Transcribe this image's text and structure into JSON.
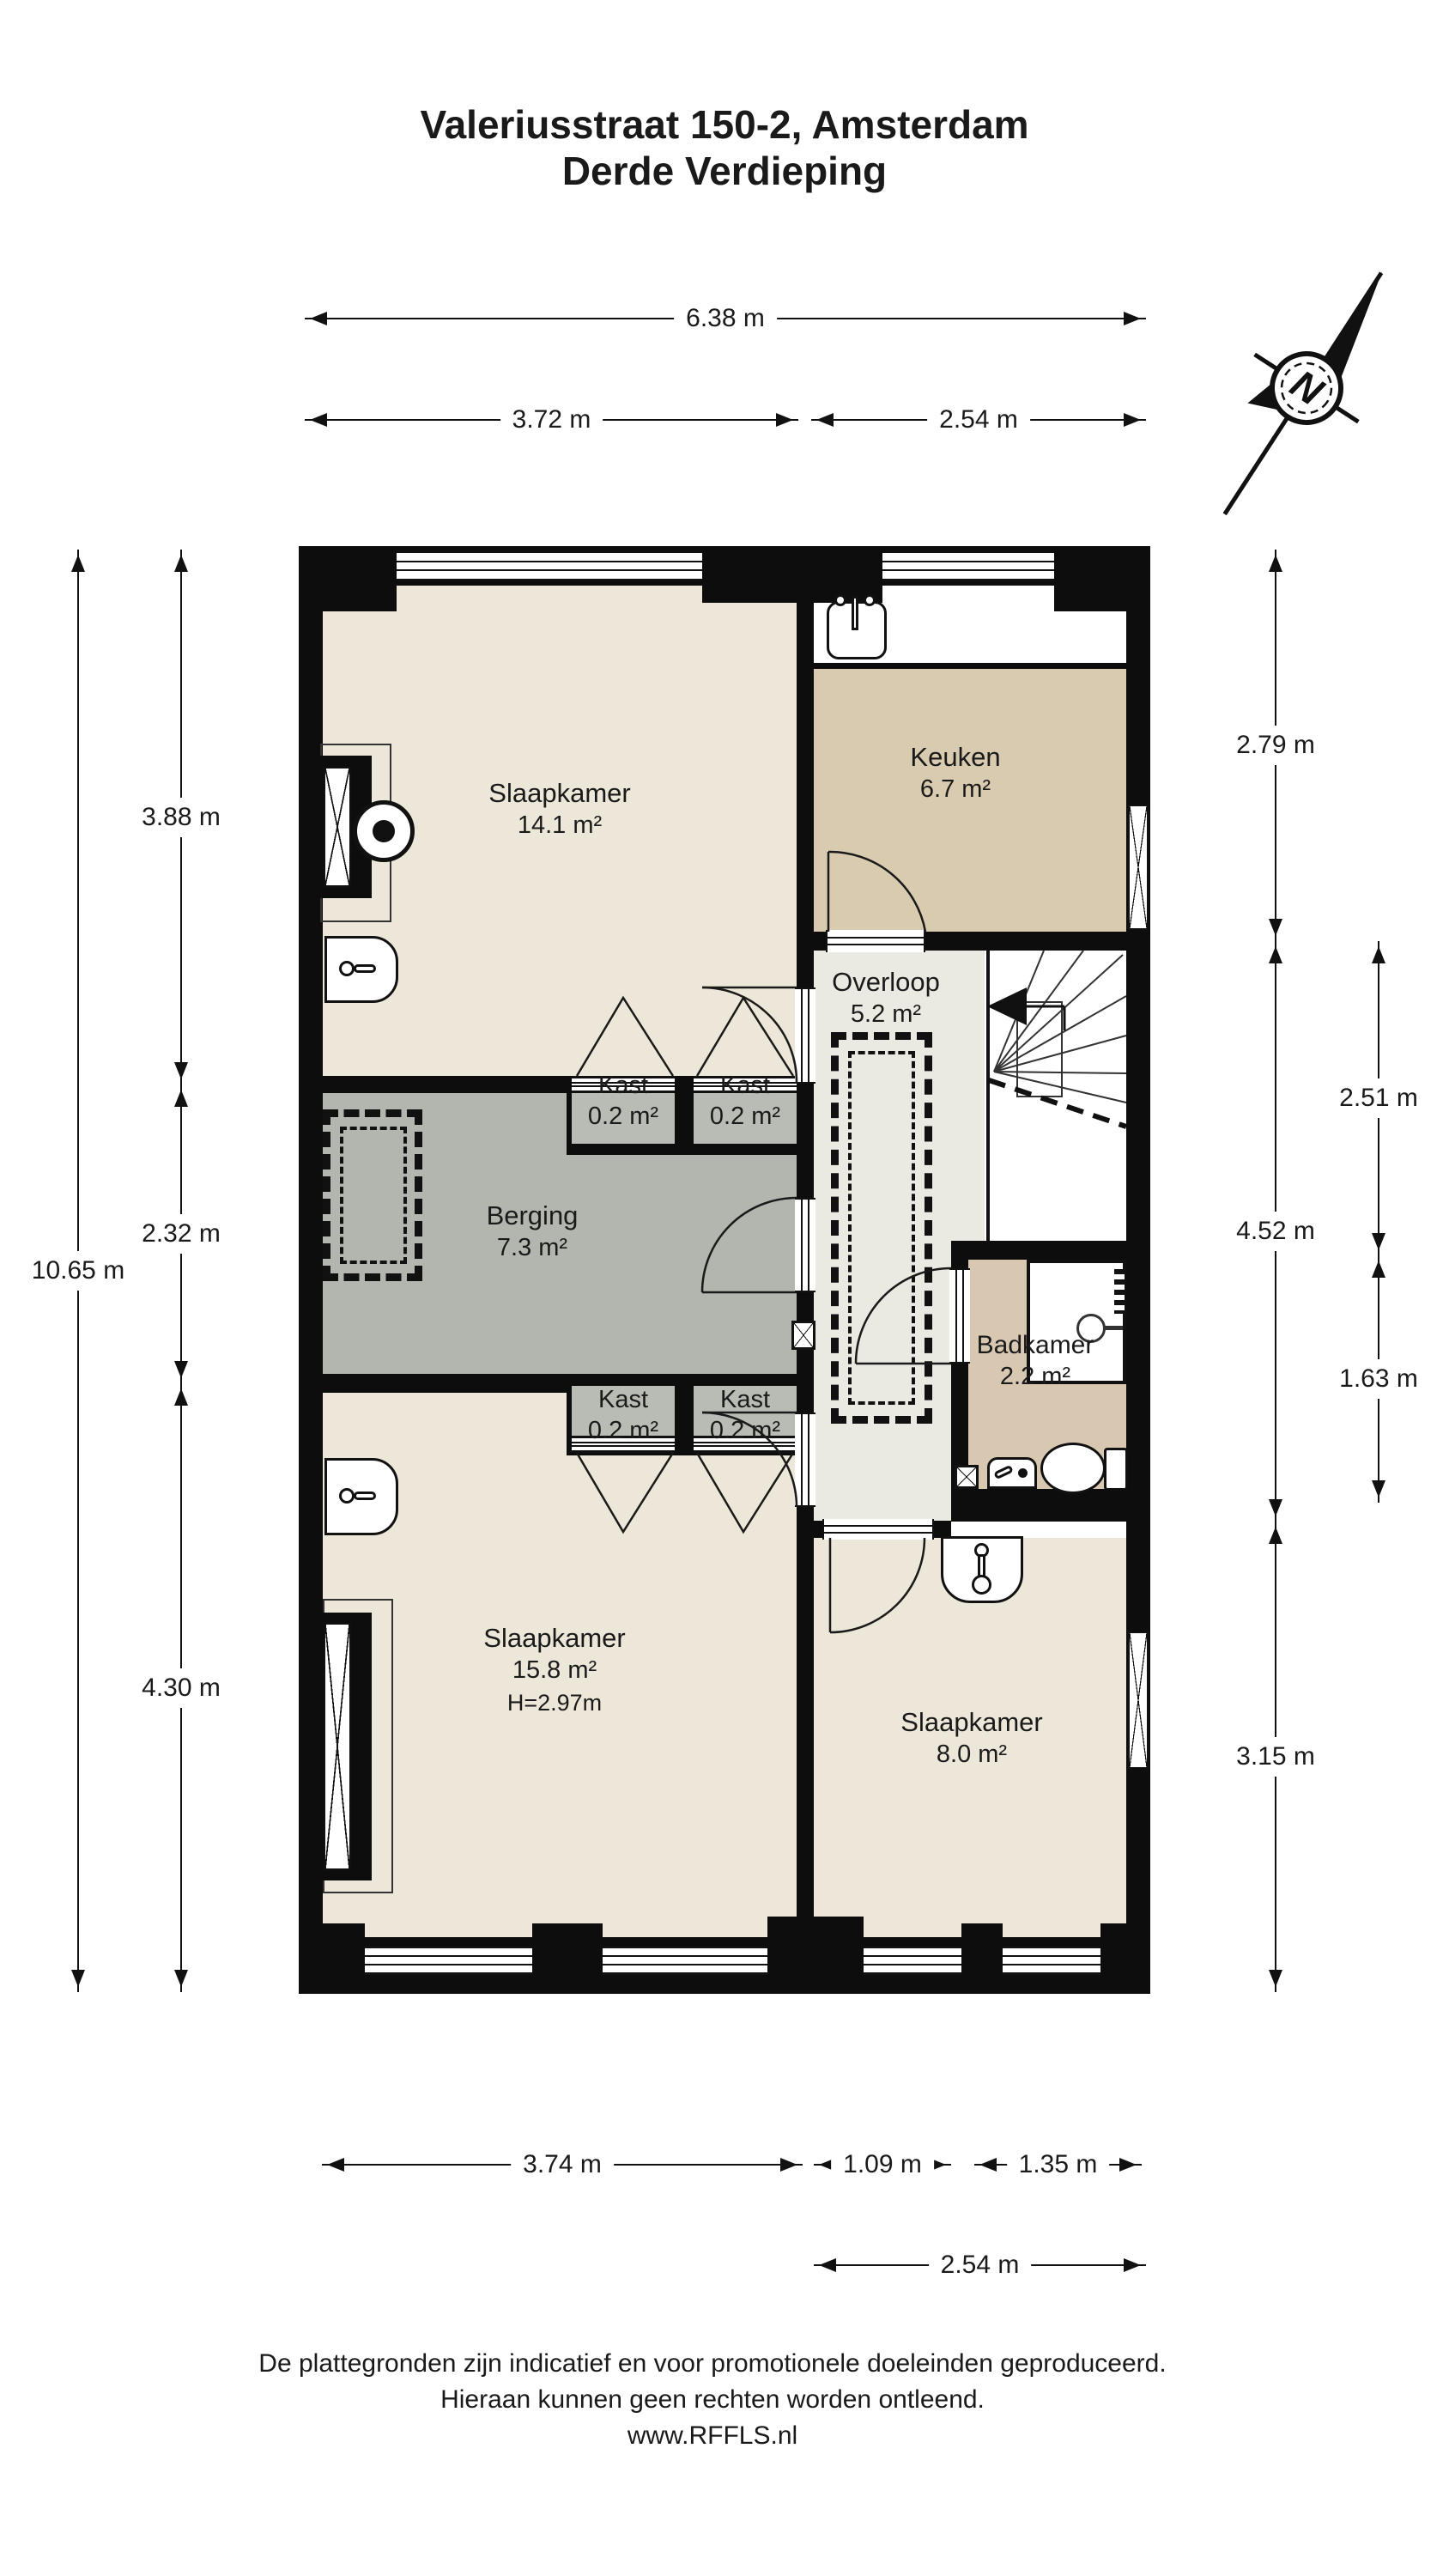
{
  "title": {
    "line1": "Valeriusstraat 150-2, Amsterdam",
    "line2": "Derde Verdieping"
  },
  "rooms": {
    "slaapkamer1": {
      "name": "Slaapkamer",
      "area": "14.1 m²"
    },
    "keuken": {
      "name": "Keuken",
      "area": "6.7 m²"
    },
    "overloop": {
      "name": "Overloop",
      "area": "5.2 m²"
    },
    "berging": {
      "name": "Berging",
      "area": "7.3 m²"
    },
    "badkamer": {
      "name": "Badkamer",
      "area": "2.2 m²"
    },
    "slaapkamer2": {
      "name": "Slaapkamer",
      "area": "15.8 m²",
      "height": "H=2.97m"
    },
    "slaapkamer3": {
      "name": "Slaapkamer",
      "area": "8.0 m²"
    },
    "kast1": {
      "name": "Kast",
      "area": "0.2 m²"
    },
    "kast2": {
      "name": "Kast",
      "area": "0.2 m²"
    },
    "kast3": {
      "name": "Kast",
      "area": "0.2 m²"
    },
    "kast4": {
      "name": "Kast",
      "area": "0.2 m²"
    }
  },
  "dimensions": {
    "top_total": "6.38 m",
    "top_left": "3.72 m",
    "top_right": "2.54 m",
    "left_total": "10.65 m",
    "left_1": "3.88 m",
    "left_2": "2.32 m",
    "left_3": "4.30 m",
    "right_1": "2.79 m",
    "right_2": "4.52 m",
    "right_3": "3.15 m",
    "right_outer_1": "2.51 m",
    "right_outer_2": "1.63 m",
    "bottom_1": "3.74 m",
    "bottom_2": "1.09 m",
    "bottom_3": "1.35 m",
    "bottom_total": "2.54 m"
  },
  "compass": {
    "north_label": "N"
  },
  "footer": {
    "line1": "De plattegronden zijn indicatief en voor promotionele doeleinden geproduceerd.",
    "line2": "Hieraan kunnen geen rechten worden ontleend.",
    "line3": "www.RFFLS.nl"
  },
  "colors": {
    "wall": "#0d0d0d",
    "bedroom_beige": "#ece7d8",
    "kitchen_tan": "#d9cbb0",
    "bathroom_tan": "#d8c8b2",
    "storage_gray": "#b3b6ae",
    "hall_gray": "#ebeae2"
  }
}
